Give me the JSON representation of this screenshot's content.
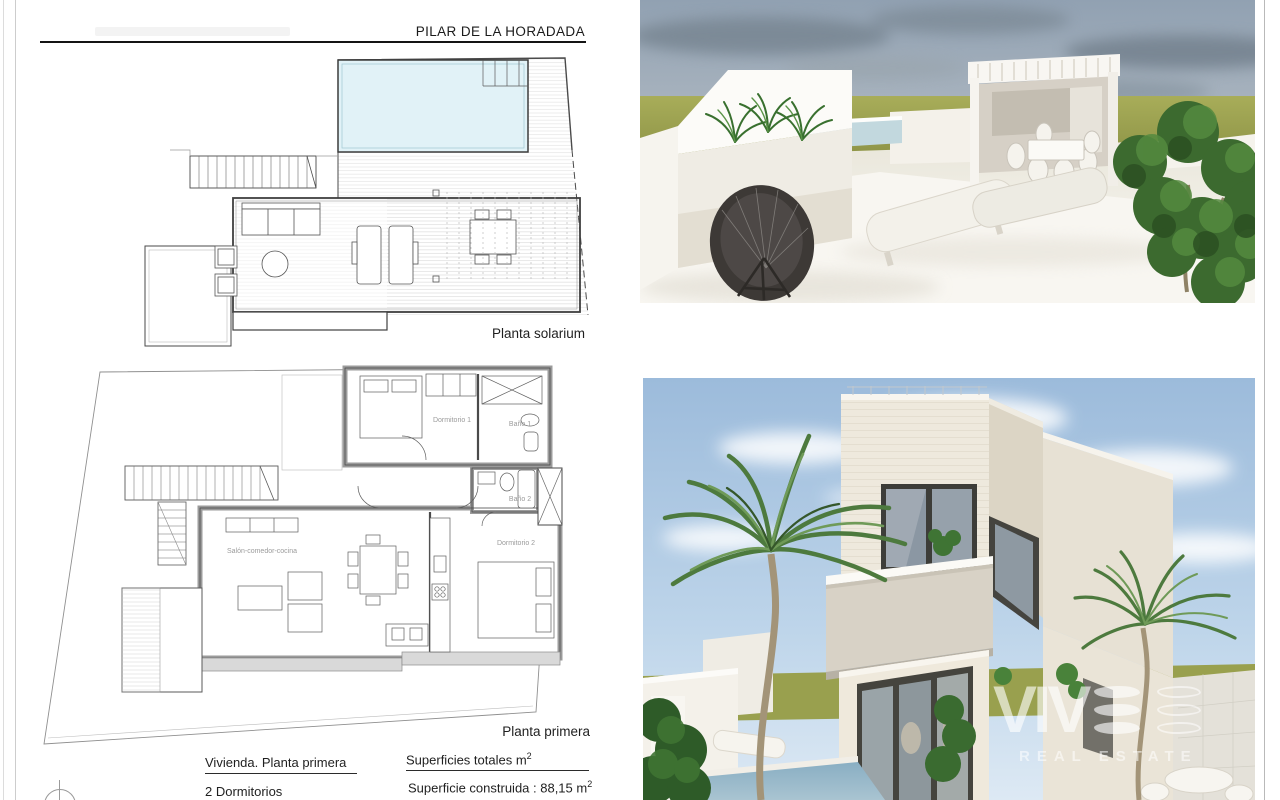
{
  "sheet": {
    "title": "PILAR DE LA HORADADA",
    "plans": {
      "solarium": {
        "label": "Planta solarium"
      },
      "first_floor": {
        "label": "Planta primera",
        "rooms": {
          "dormitorio1": "Dormitorio 1",
          "bano1": "Baño 1",
          "bano2": "Baño 2",
          "dormitorio2": "Dormitorio 2",
          "salon_comedor_cocina": "Salón-comedor-cocina"
        }
      }
    },
    "summary": {
      "dwelling_heading": "Vivienda. Planta primera",
      "bedrooms": "2  Dormitorios",
      "areas_heading": "Superficies totales m",
      "areas_heading_sup": "2",
      "built_area_label": "Superficie construida : 88,15 m",
      "built_area_sup": "2",
      "built_area_value": "88,15"
    }
  },
  "watermark": {
    "brand": "VIVE",
    "brand_prefix": "VIV",
    "subtitle": "REAL ESTATE"
  },
  "colors": {
    "pool_plan": "#e1f2f7",
    "plan_wall_gray": "#d9d9d9",
    "terrace_sky": "#97a6b5",
    "field_green": "#9aa04d",
    "villa_sky": "#a7c4e0",
    "villa_stone": "#e9e3d7",
    "pool_render": "#8fb2c6",
    "watermark_white": "rgba(255,255,255,0.6)"
  }
}
